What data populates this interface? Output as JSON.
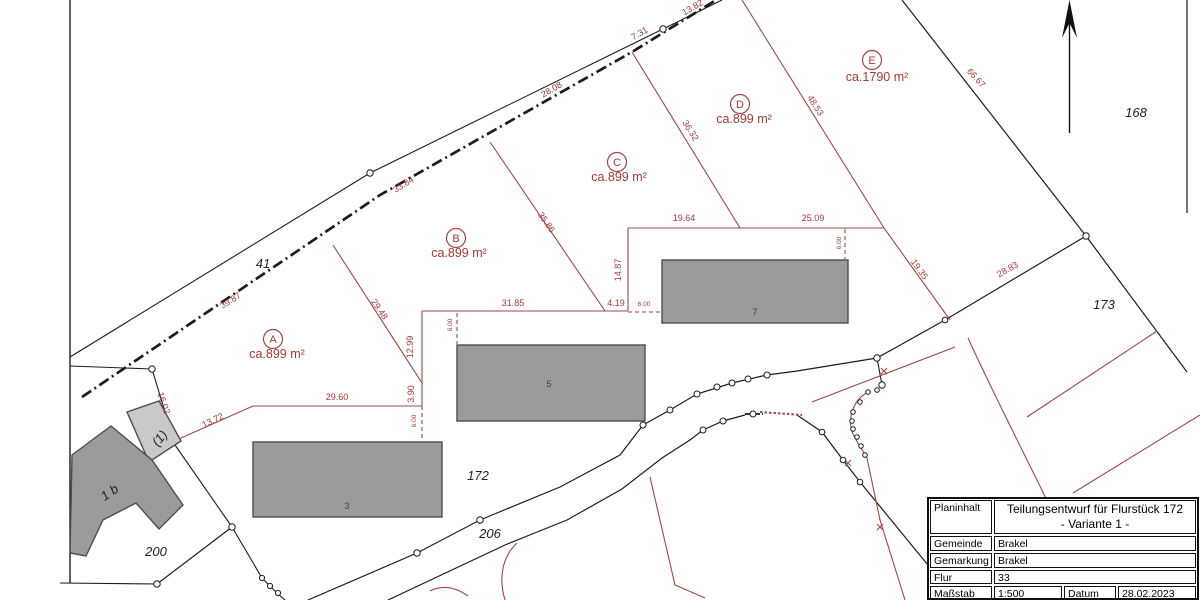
{
  "plan": {
    "parcel_numbers": {
      "p41": "41",
      "p168": "168",
      "p172": "172",
      "p173": "173",
      "p200": "200",
      "p206": "206",
      "house_1b": "1 b",
      "annex": "(1)"
    },
    "buildings": {
      "b3": "3",
      "b5": "5",
      "b7": "7"
    },
    "parcels": [
      {
        "letter": "A",
        "area": "ca.899 m²"
      },
      {
        "letter": "B",
        "area": "ca.899 m²"
      },
      {
        "letter": "C",
        "area": "ca.899 m²"
      },
      {
        "letter": "D",
        "area": "ca.899 m²"
      },
      {
        "letter": "E",
        "area": "ca.1790 m²"
      }
    ],
    "measurements": [
      "39.87",
      "33.84",
      "28.08",
      "7.31",
      "13.82",
      "29.48",
      "12.99",
      "3.90",
      "29.60",
      "13.72",
      "16.02",
      "31.85",
      "4.19",
      "35.86",
      "36.32",
      "14.87",
      "19.64",
      "25.09",
      "48.53",
      "66.67",
      "19.35",
      "28.83",
      "6.00",
      "6.00",
      "6.00",
      "6.00"
    ],
    "colors": {
      "boundary_black": "#1c1c1c",
      "divider_red": "#9e4747",
      "building_fill": "#9b9b9b",
      "annex_fill": "#c9c9c9"
    }
  },
  "title_block": {
    "row1_label": "Planinhalt",
    "row1_value_line1": "Teilungsentwurf für Flurstück 172",
    "row1_value_line2": "- Variante 1 -",
    "row2_label": "Gemeinde",
    "row2_value": "Brakel",
    "row3_label": "Gemarkung",
    "row3_value": "Brakel",
    "row4_label": "Flur",
    "row4_value": "33",
    "row5_label": "Maßstab",
    "row5_value": "1:500",
    "row5_label2": "Datum",
    "row5_value2": "28.02.2023"
  }
}
